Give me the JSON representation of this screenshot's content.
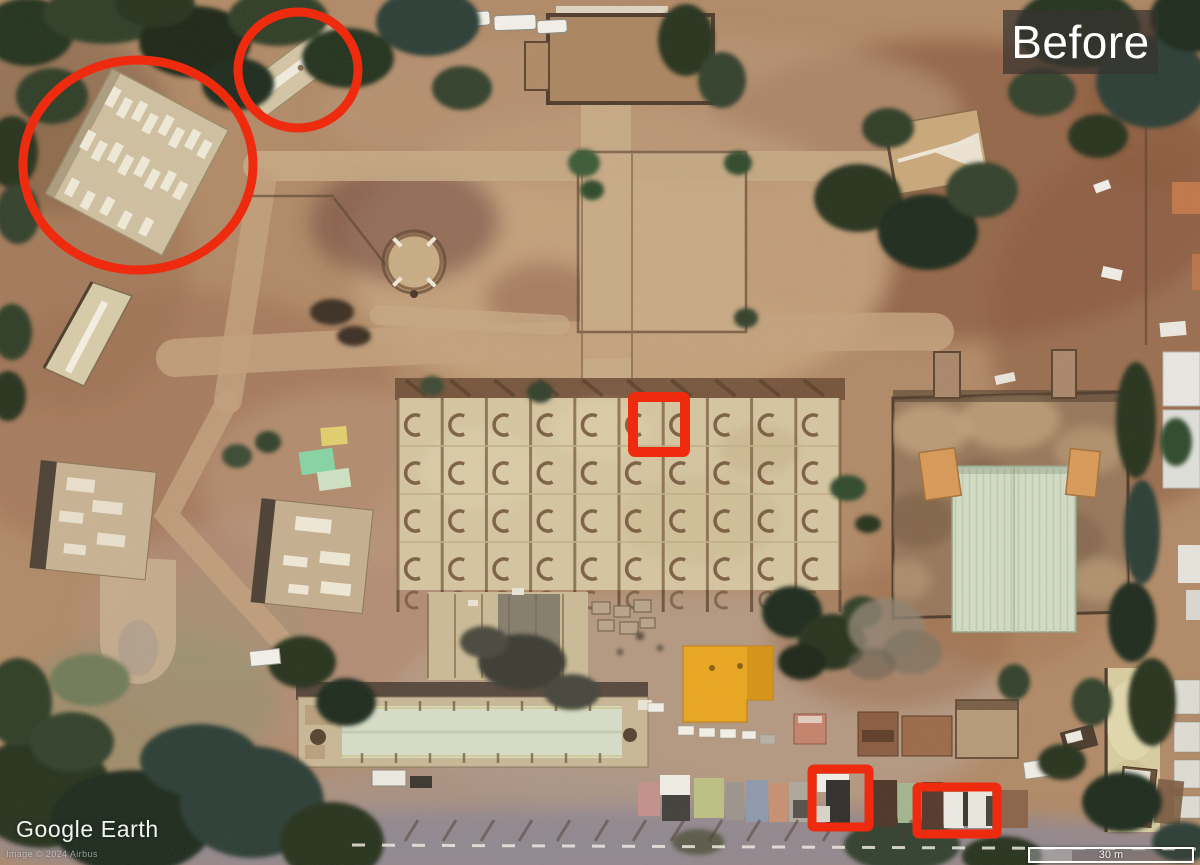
{
  "hud": {
    "state_label": "Before",
    "watermark": "Google Earth",
    "attribution": "Image © 2024 Airbus",
    "scale_label": "30 m"
  },
  "annotation": {
    "color": "#ee2b0f",
    "shapes": [
      {
        "kind": "ellipse",
        "name": "annotation-circle-warehouse",
        "cx": 138,
        "cy": 165,
        "rx": 115,
        "ry": 105,
        "stroke": 9
      },
      {
        "kind": "ellipse",
        "name": "annotation-circle-long-building",
        "cx": 298,
        "cy": 70,
        "rx": 60,
        "ry": 58,
        "stroke": 9
      },
      {
        "kind": "rect",
        "name": "annotation-box-rooftop",
        "x": 633,
        "y": 397,
        "w": 52,
        "h": 55,
        "stroke": 10
      },
      {
        "kind": "rect",
        "name": "annotation-box-vehicle-left",
        "x": 812,
        "y": 769,
        "w": 57,
        "h": 58,
        "stroke": 9
      },
      {
        "kind": "rect",
        "name": "annotation-box-vehicles-right",
        "x": 917,
        "y": 787,
        "w": 80,
        "h": 47,
        "stroke": 9
      }
    ]
  },
  "scene": {
    "description": "Aerial satellite view of a walled compound: barracks with white roof vents (circled), long narrow building (circled), large modular-roof block, courtyards, dirt roads, trees and rows of parked trucks (boxed)."
  }
}
